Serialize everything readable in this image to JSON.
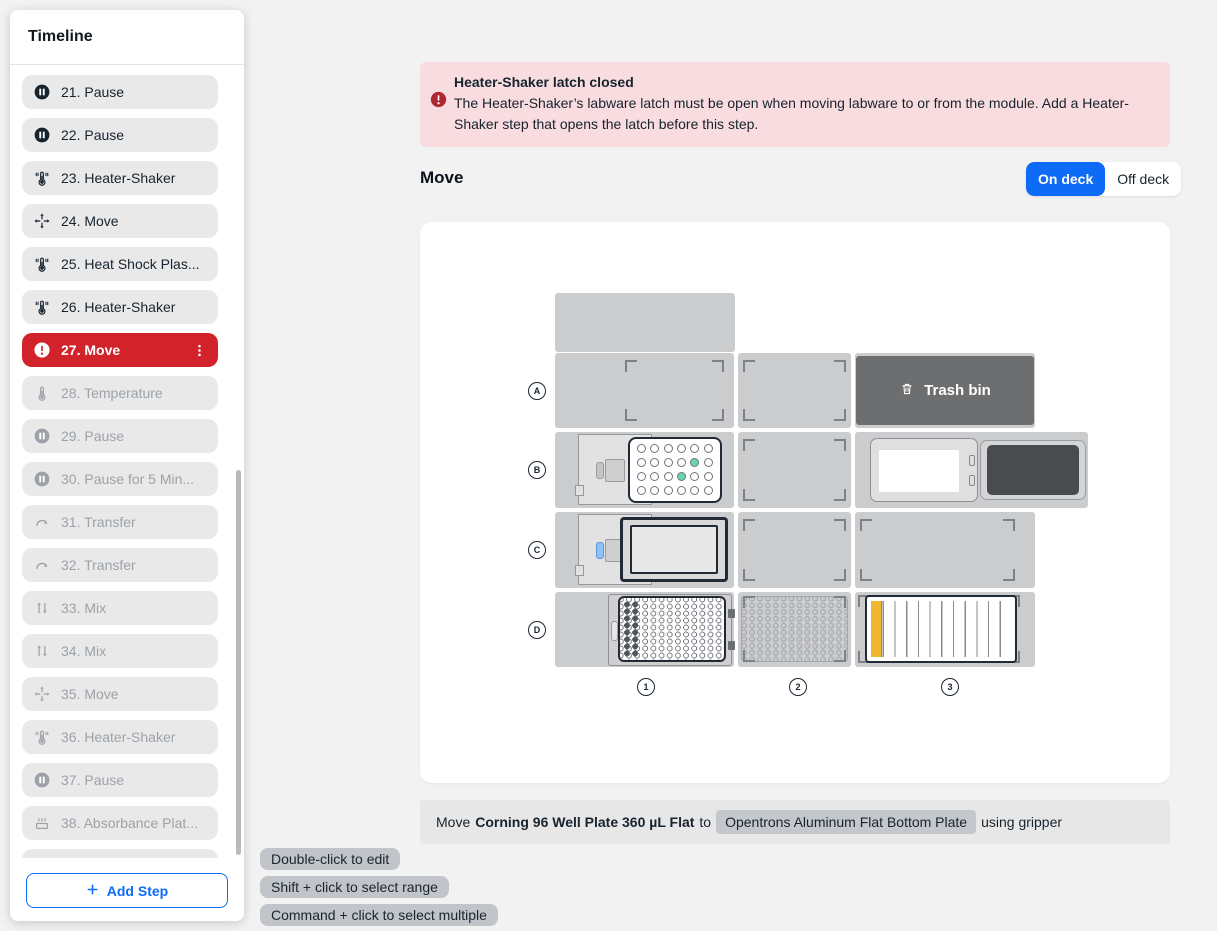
{
  "sidebar": {
    "title": "Timeline",
    "add_step_label": "Add Step",
    "steps": [
      {
        "label": "21. Pause",
        "icon": "pause",
        "state": "normal"
      },
      {
        "label": "22. Pause",
        "icon": "pause",
        "state": "normal"
      },
      {
        "label": "23. Heater-Shaker",
        "icon": "heater-shaker",
        "state": "normal"
      },
      {
        "label": "24. Move",
        "icon": "move",
        "state": "normal"
      },
      {
        "label": "25. Heat Shock Plas...",
        "icon": "heater-shaker",
        "state": "normal"
      },
      {
        "label": "26. Heater-Shaker",
        "icon": "heater-shaker",
        "state": "normal"
      },
      {
        "label": "27. Move",
        "icon": "alert",
        "state": "selected"
      },
      {
        "label": "28. Temperature",
        "icon": "temperature",
        "state": "disabled"
      },
      {
        "label": "29. Pause",
        "icon": "pause",
        "state": "disabled"
      },
      {
        "label": "30. Pause for 5 Min...",
        "icon": "pause",
        "state": "disabled"
      },
      {
        "label": "31. Transfer",
        "icon": "transfer",
        "state": "disabled"
      },
      {
        "label": "32. Transfer",
        "icon": "transfer",
        "state": "disabled"
      },
      {
        "label": "33. Mix",
        "icon": "mix",
        "state": "disabled"
      },
      {
        "label": "34. Mix",
        "icon": "mix",
        "state": "disabled"
      },
      {
        "label": "35. Move",
        "icon": "move",
        "state": "disabled"
      },
      {
        "label": "36. Heater-Shaker",
        "icon": "heater-shaker",
        "state": "disabled"
      },
      {
        "label": "37. Pause",
        "icon": "pause",
        "state": "disabled"
      },
      {
        "label": "38. Absorbance Plat...",
        "icon": "absorbance",
        "state": "disabled"
      },
      {
        "label": "39. Heater-Shaker",
        "icon": "heater-shaker",
        "state": "disabled"
      }
    ]
  },
  "banner": {
    "title": "Heater-Shaker latch closed",
    "body": "The Heater-Shaker’s labware latch must be open when moving labware to or from the module. Add a Heater-Shaker step that opens the latch before this step."
  },
  "header": {
    "title": "Move",
    "deck_toggle": {
      "on_label": "On deck",
      "off_label": "Off deck",
      "selected": "On deck"
    }
  },
  "deck": {
    "row_labels": [
      "A",
      "B",
      "C",
      "D"
    ],
    "column_labels": [
      "1",
      "2",
      "3"
    ],
    "trash_label": "Trash bin",
    "plate24_highlight_wells": [
      [
        1,
        4
      ],
      [
        2,
        3
      ]
    ]
  },
  "summary": {
    "prefix": "Move",
    "source": "Corning 96 Well Plate 360 µL Flat",
    "connector": "to",
    "destination": "Opentrons Aluminum Flat Bottom Plate",
    "suffix": "using gripper"
  },
  "tooltips": [
    "Double-click to edit",
    "Shift + click to select range",
    "Command + click to select multiple"
  ],
  "colors": {
    "accent_blue": "#0D6BF8",
    "error_red": "#D2232B",
    "banner_bg": "#F8DCDF",
    "banner_icon": "#AF2730",
    "slot_gray": "#CBCCCD",
    "trash_gray": "#6C6E70",
    "well_green": "#67D6AC",
    "reservoir_yellow": "#F0B632"
  }
}
